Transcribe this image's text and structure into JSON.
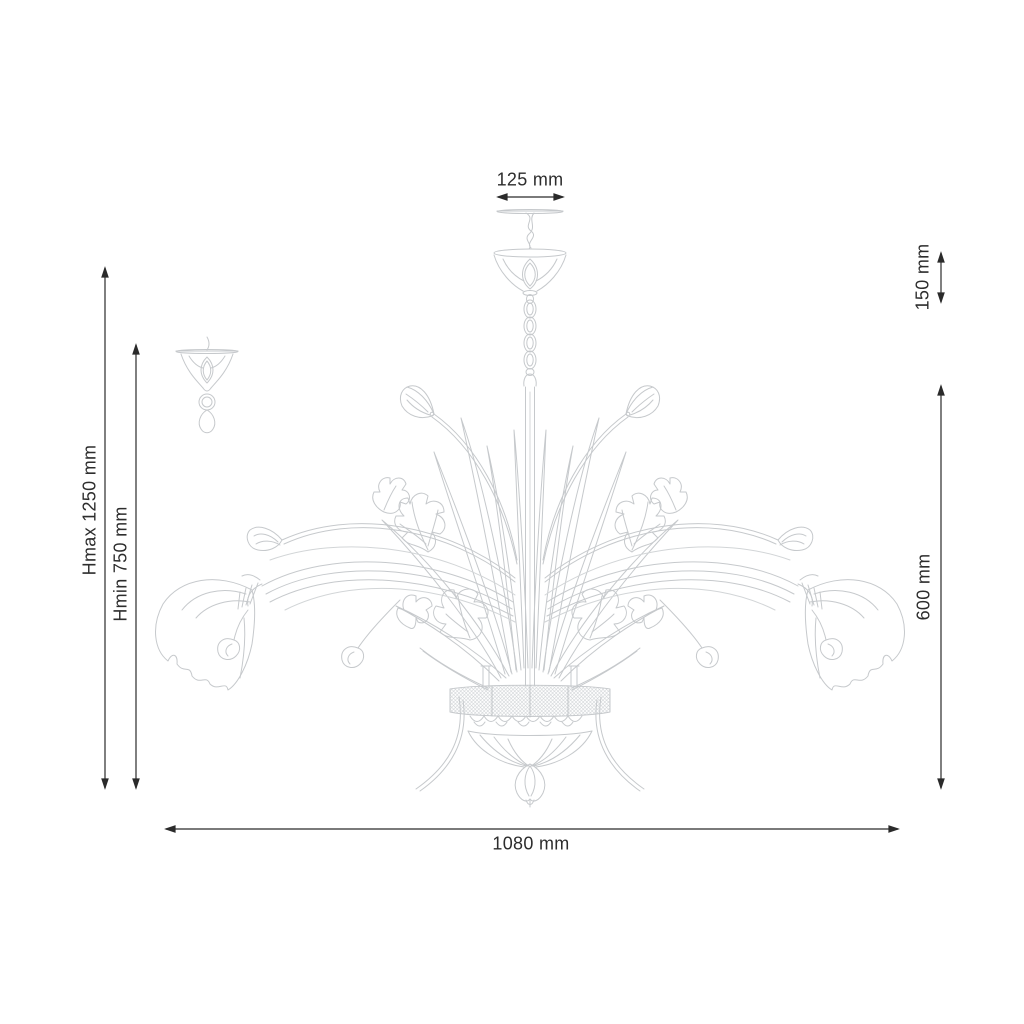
{
  "document": {
    "type": "technical dimension drawing of a floral chandelier",
    "units": "mm",
    "background_color": "#ffffff",
    "artwork_line_color": "#c6c9cc",
    "dimension_color": "#2d2d2d"
  },
  "dimensions": {
    "canopy_width": {
      "label": "125 mm",
      "orientation": "horizontal",
      "position": "top"
    },
    "canopy_height": {
      "label": "150 mm",
      "orientation": "vertical",
      "position": "upper-right"
    },
    "body_height": {
      "label": "600 mm",
      "orientation": "vertical",
      "position": "right"
    },
    "max_height": {
      "label": "Hmax 1250 mm",
      "orientation": "vertical",
      "position": "left-outer"
    },
    "min_height": {
      "label": "Hmin 750 mm",
      "orientation": "vertical",
      "position": "left-inner"
    },
    "total_width": {
      "label": "1080 mm",
      "orientation": "horizontal",
      "position": "bottom"
    }
  }
}
